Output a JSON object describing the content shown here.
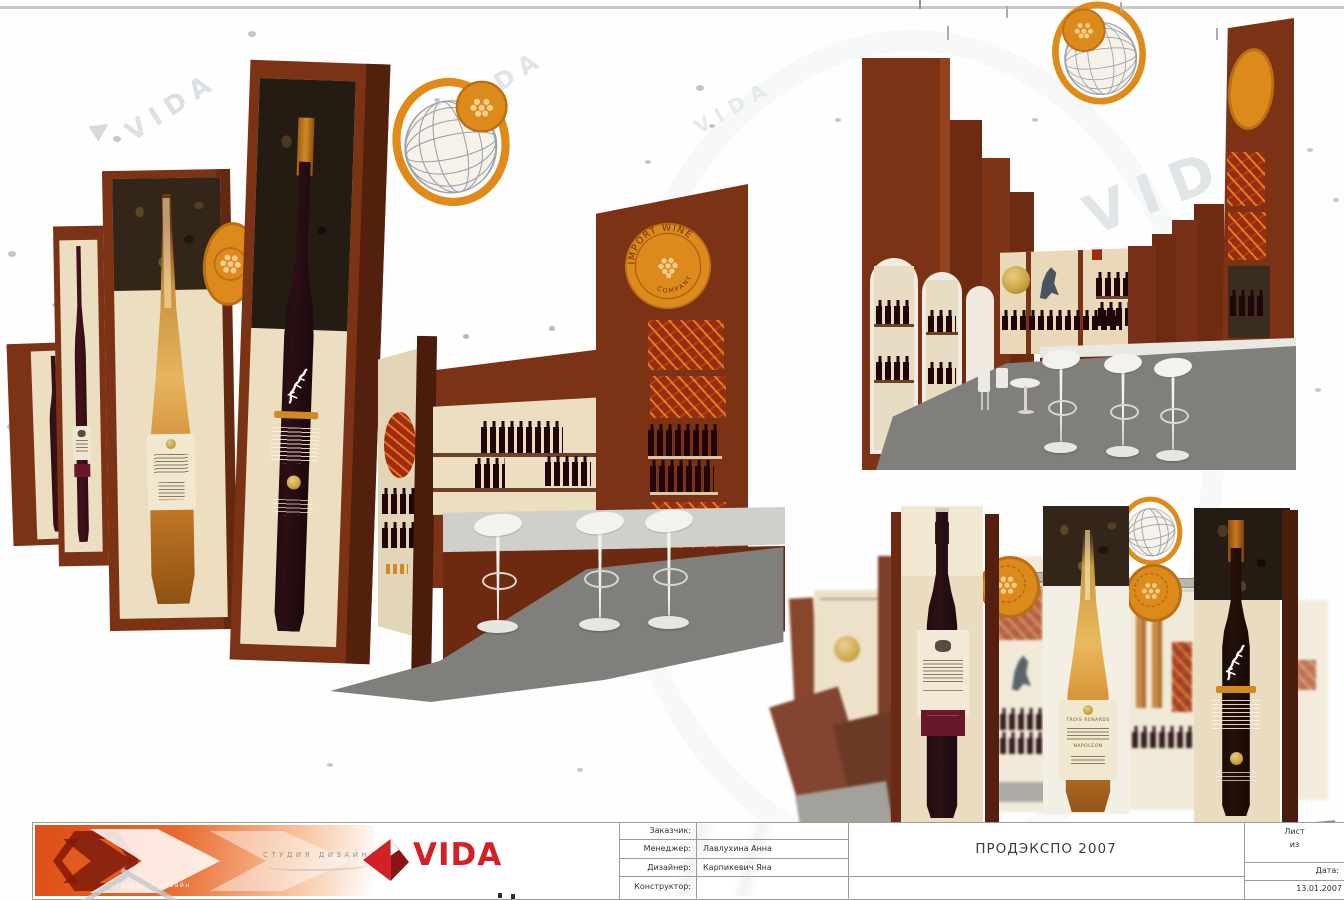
{
  "title_block": {
    "fields": [
      {
        "label": "Заказчик:",
        "value": ""
      },
      {
        "label": "Менеджер:",
        "value": "Лавлухина Анна"
      },
      {
        "label": "Дизайнер:",
        "value": "Карпикевич Яна"
      },
      {
        "label": "Конструктор:",
        "value": ""
      }
    ],
    "project_title": "ПРОДЭКСПО 2007",
    "sheet_label": "Лист",
    "sheet_of": "из",
    "date_label": "Дата:",
    "date_value": "13.01.2007",
    "logo": {
      "brand": "VIDA",
      "tagline": "СТУДИЯ ДИЗАЙНА",
      "slogan": "выставки и дизайн"
    }
  },
  "branding": {
    "import_wine_top": "IMPORT WINE",
    "import_wine_bottom": "COMPANY"
  },
  "bottles": {
    "cognac_line1": "TROIS RENARDS",
    "cognac_line2": "NAPOLEON"
  },
  "watermark": {
    "text": "VIDA"
  },
  "colors": {
    "brown": "#7c3315",
    "brown_dark": "#5a2210",
    "brown_deep": "#471a0a",
    "cream": "#ebdec1",
    "cream_light": "#f3ead6",
    "panel_dark": "#2e2418",
    "orange": "#de8a1c",
    "orange_deep": "#b96f12",
    "red_panel": "#9c2a13",
    "carpet": "#807f7b",
    "counter": "#cfcfcc",
    "white_obj": "#f2f1ed",
    "vida_red": "#d32027",
    "line": "#9b9b9b",
    "wine_dark": "#1c0c11",
    "amber": "#c98f3a",
    "gold": "#c9a23e"
  }
}
